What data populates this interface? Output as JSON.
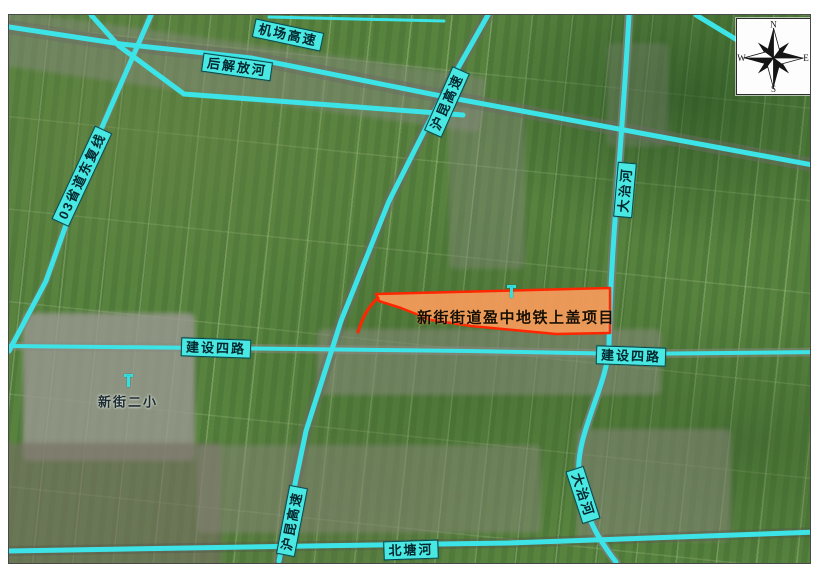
{
  "map_labels": {
    "airport_expressway": "机场高速",
    "hou_jiefang_river": "后解放河",
    "provincial_road_03": "03省道东复线",
    "hukun_expressway_top": "沪昆高速",
    "hukun_expressway_bottom": "沪昆高速",
    "dazhi_river_top": "大治河",
    "dazhi_river_bottom": "大治河",
    "jianshe_fourth_road_left": "建设四路",
    "jianshe_fourth_road_right": "建设四路",
    "beitang_river": "北塘河"
  },
  "annotations": {
    "project_site": "新街街道盈中地铁上盖项目",
    "school": "新街二小"
  },
  "compass": {
    "north": "N",
    "east": "E",
    "south": "S",
    "west": "W"
  },
  "colors": {
    "overlay_cyan": "#3ce4e8",
    "label_background": "#4ae8e2",
    "site_fill": "#f79b5b",
    "site_outline": "#ff2600"
  }
}
